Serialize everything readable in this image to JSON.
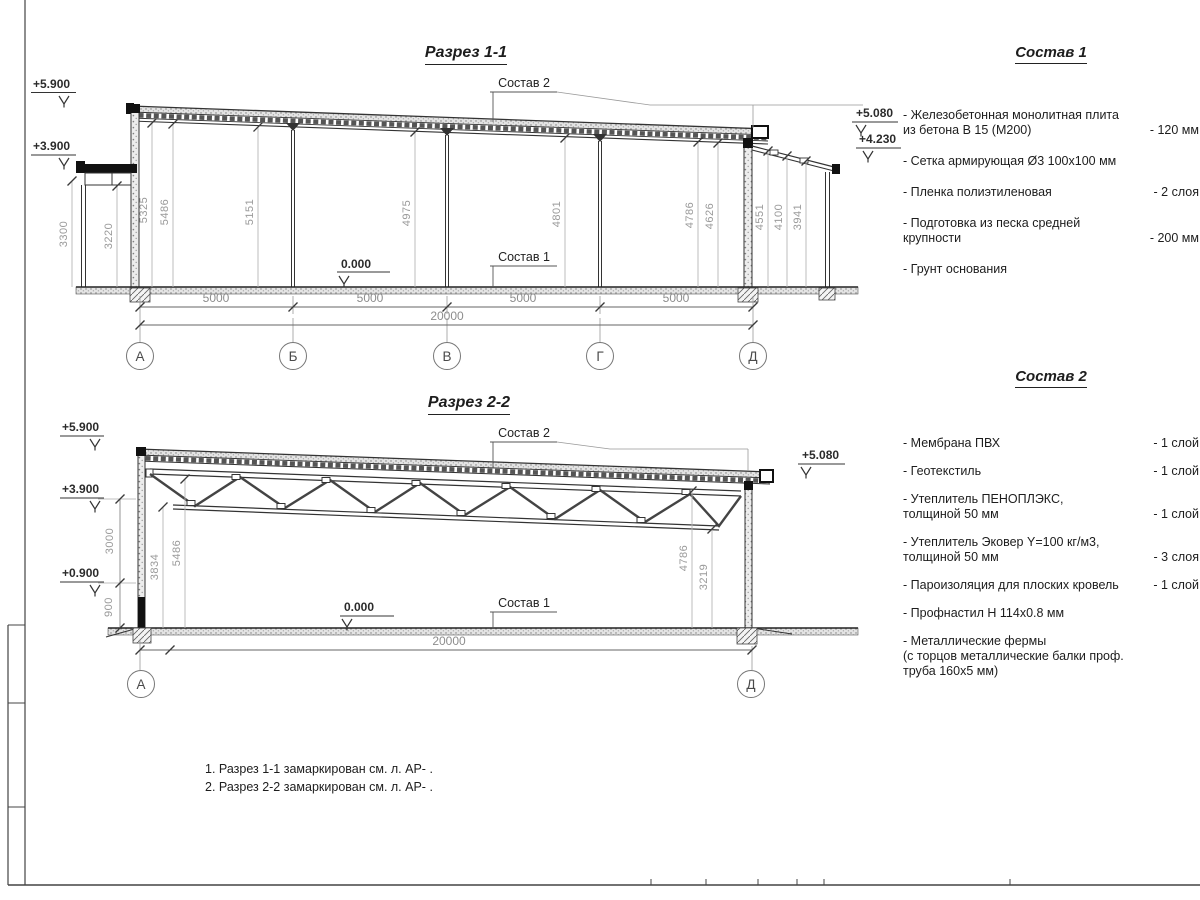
{
  "section1": {
    "title": "Разрез 1-1",
    "callout_top": "Состав 2",
    "callout_bottom": "Состав 1",
    "zero_mark": "0.000",
    "elev_left_top": "+5.900",
    "elev_left_mid": "+3.900",
    "elev_right_top": "+5.080",
    "elev_right_mid": "+4.230",
    "heights": [
      "3300",
      "3220",
      "5325",
      "5486",
      "5151",
      "4975",
      "4801",
      "4786",
      "4626",
      "4551",
      "4100",
      "3941"
    ],
    "spans": [
      "5000",
      "5000",
      "5000",
      "5000"
    ],
    "total": "20000",
    "axes": [
      "А",
      "Б",
      "В",
      "Г",
      "Д"
    ]
  },
  "section2": {
    "title": "Разрез 2-2",
    "callout_top": "Состав 2",
    "callout_bottom": "Состав 1",
    "zero_mark": "0.000",
    "elev_left_top": "+5.900",
    "elev_left_mid": "+3.900",
    "elev_left_low": "+0.900",
    "elev_right_top": "+5.080",
    "heights": [
      "3000",
      "900",
      "3834",
      "5486",
      "4786",
      "3219"
    ],
    "total": "20000",
    "axes": [
      "А",
      "Д"
    ]
  },
  "composition1": {
    "title": "Состав 1",
    "items": [
      {
        "name": "- Железобетонная  монолитная плита\nиз бетона В 15 (М200)",
        "value": "- 120 мм"
      },
      {
        "name": "- Сетка армирующая Ø3 100х100 мм",
        "value": ""
      },
      {
        "name": "- Пленка полиэтиленовая",
        "value": "- 2 слоя"
      },
      {
        "name": "- Подготовка из песка средней\nкрупности",
        "value": "- 200 мм"
      },
      {
        "name": "- Грунт основания",
        "value": ""
      }
    ]
  },
  "composition2": {
    "title": "Состав 2",
    "items": [
      {
        "name": "- Мембрана ПВХ",
        "value": "- 1 слой"
      },
      {
        "name": "- Геотекстиль",
        "value": "- 1 слой"
      },
      {
        "name": "- Утеплитель ПЕНОПЛЭКС,\nтолщиной 50 мм",
        "value": "- 1 слой"
      },
      {
        "name": "- Утеплитель Эковер Y=100 кг/м3,\nтолщиной 50 мм",
        "value": "- 3 слоя"
      },
      {
        "name": "- Пароизоляция для плоских кровель",
        "value": "- 1 слой"
      },
      {
        "name": "- Профнастил Н 114х0.8 мм",
        "value": ""
      },
      {
        "name": "- Металлические фермы\n(с торцов металлические балки проф.\nтруба 160х5 мм)",
        "value": ""
      }
    ]
  },
  "notes": [
    "1. Разрез 1-1 замаркирован см. л. АР- .",
    "2. Разрез 2-2 замаркирован см. л. АР- ."
  ]
}
